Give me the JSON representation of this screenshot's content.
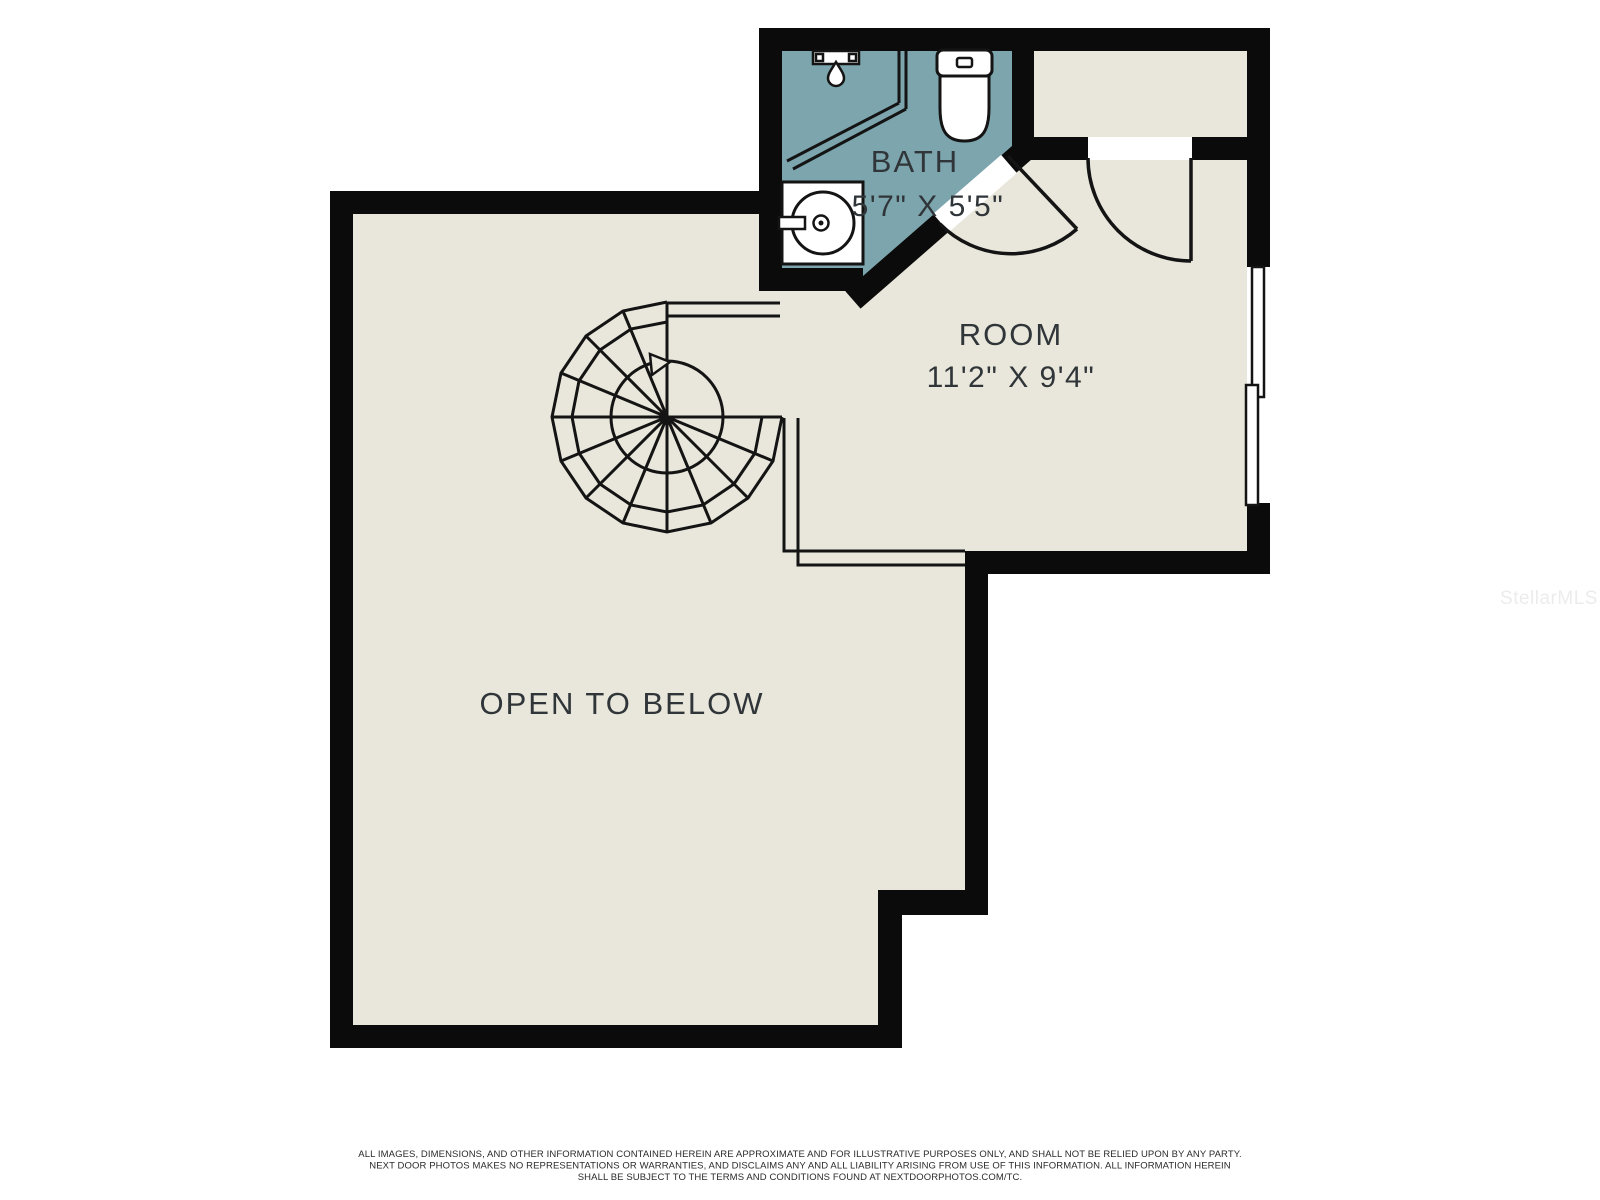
{
  "colors": {
    "wall": "#0b0b0b",
    "floor": "#e9e7db",
    "bath_floor": "#7ca5ad",
    "line": "#141414",
    "label": "#2f3538",
    "watermark": "#ececec",
    "disclaimer": "#2b2b2b",
    "fixture_fill": "#ffffff"
  },
  "rooms": {
    "bath": {
      "name": "BATH",
      "dimensions": "5'7\" X 5'5\""
    },
    "room": {
      "name": "ROOM",
      "dimensions": "11'2\" X 9'4\""
    },
    "open_to_below": {
      "name": "OPEN TO BELOW"
    }
  },
  "watermark": "StellarMLS",
  "disclaimer": {
    "line1": "ALL IMAGES, DIMENSIONS, AND OTHER INFORMATION CONTAINED HEREIN ARE APPROXIMATE AND FOR ILLUSTRATIVE PURPOSES ONLY, AND SHALL NOT BE RELIED UPON BY ANY PARTY.",
    "line2": "NEXT DOOR PHOTOS MAKES NO REPRESENTATIONS OR WARRANTIES, AND DISCLAIMS ANY AND ALL LIABILITY ARISING FROM USE OF THIS INFORMATION. ALL INFORMATION HEREIN",
    "line3": "SHALL BE SUBJECT TO THE TERMS AND CONDITIONS FOUND AT NEXTDOORPHOTOS.COM/TC."
  }
}
